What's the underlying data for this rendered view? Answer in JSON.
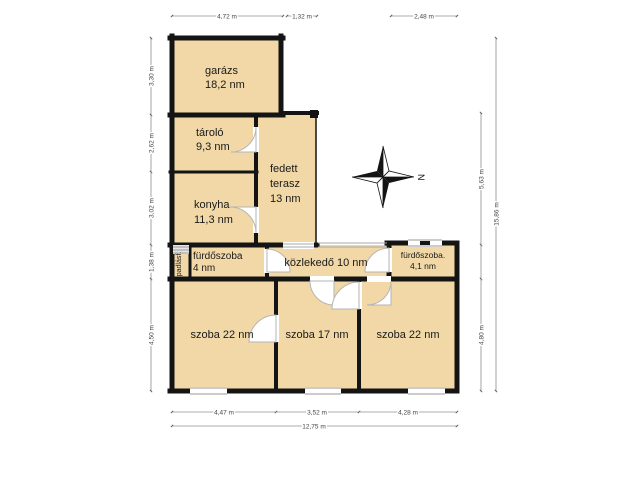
{
  "page": {
    "type": "floor-plan"
  },
  "colors": {
    "room_fill": "#f1d8a6",
    "wall": "#141414",
    "dim_text": "#444444"
  },
  "compass": {
    "label": "N"
  },
  "rooms": {
    "garage": {
      "name": "garázs",
      "area": "18,2 nm"
    },
    "storage": {
      "name": "tároló",
      "area": "9,3 nm"
    },
    "terrace": {
      "name_line1": "fedett",
      "name_line2": "terasz",
      "area": "13 nm"
    },
    "kitchen": {
      "name": "konyha",
      "area": "11,3 nm"
    },
    "attic_stairs": {
      "name": "padlásf."
    },
    "bathroom_left": {
      "name": "fürdőszoba",
      "area": "4 nm"
    },
    "hallway": {
      "label": "közlekedő 10 nm"
    },
    "bathroom_right": {
      "name": "fürdőszoba.",
      "area": "4,1 nm"
    },
    "bedroom_left": {
      "label": "szoba 22 nm"
    },
    "bedroom_middle": {
      "label": "szoba 17 nm"
    },
    "bedroom_right": {
      "label": "szoba 22 nm"
    }
  },
  "dimensions": {
    "top": [
      "4,72 m",
      "1,32 m",
      "2,48 m"
    ],
    "left": [
      "3,30 m",
      "2,62 m",
      "3,02 m",
      "1,38 m",
      "4,50 m"
    ],
    "right_inner": [
      "5,63 m",
      "4,80 m"
    ],
    "right_total": "15,86 m",
    "bottom": [
      "4,47 m",
      "3,52 m",
      "4,28 m"
    ],
    "bottom_total": "12,75 m"
  }
}
